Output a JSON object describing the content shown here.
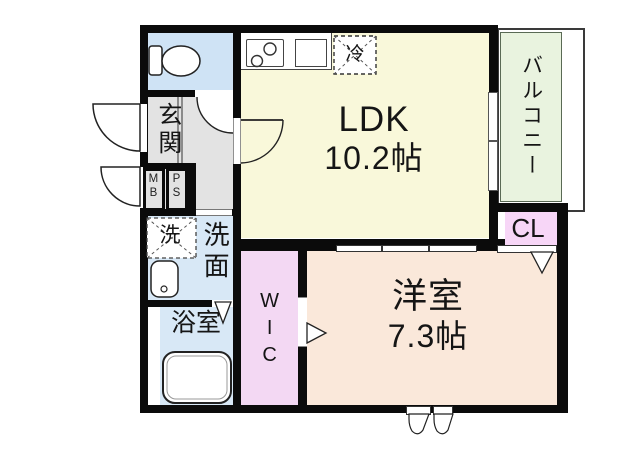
{
  "floor_plan": {
    "rooms": {
      "ldk": {
        "label": "LDK",
        "size": "10.2帖"
      },
      "western_room": {
        "label": "洋室",
        "size": "7.3帖"
      },
      "balcony": {
        "label": "バルコニー"
      },
      "closet": {
        "label": "CL"
      },
      "walk_in_closet": {
        "label": "WIC"
      },
      "entrance": {
        "label": "玄関"
      },
      "washroom": {
        "label": "洗面"
      },
      "bathroom": {
        "label": "浴室"
      },
      "meter_box": {
        "label": "MB"
      },
      "pipe_space": {
        "label": "PS"
      }
    },
    "fixtures": {
      "washer": {
        "label": "洗"
      },
      "refrigerator": {
        "label": "冷"
      }
    },
    "colors": {
      "wall": "#0b0b0b",
      "ldk": "#F9F8DA",
      "western_room": "#FAE8DA",
      "wet_area": "#D8E8F6",
      "toilet": "#CFE3F5",
      "wic": "#F3D8F3",
      "closet": "#F7D6F7",
      "balcony": "#E9F3DF",
      "hall": "#E3E3E3"
    }
  }
}
